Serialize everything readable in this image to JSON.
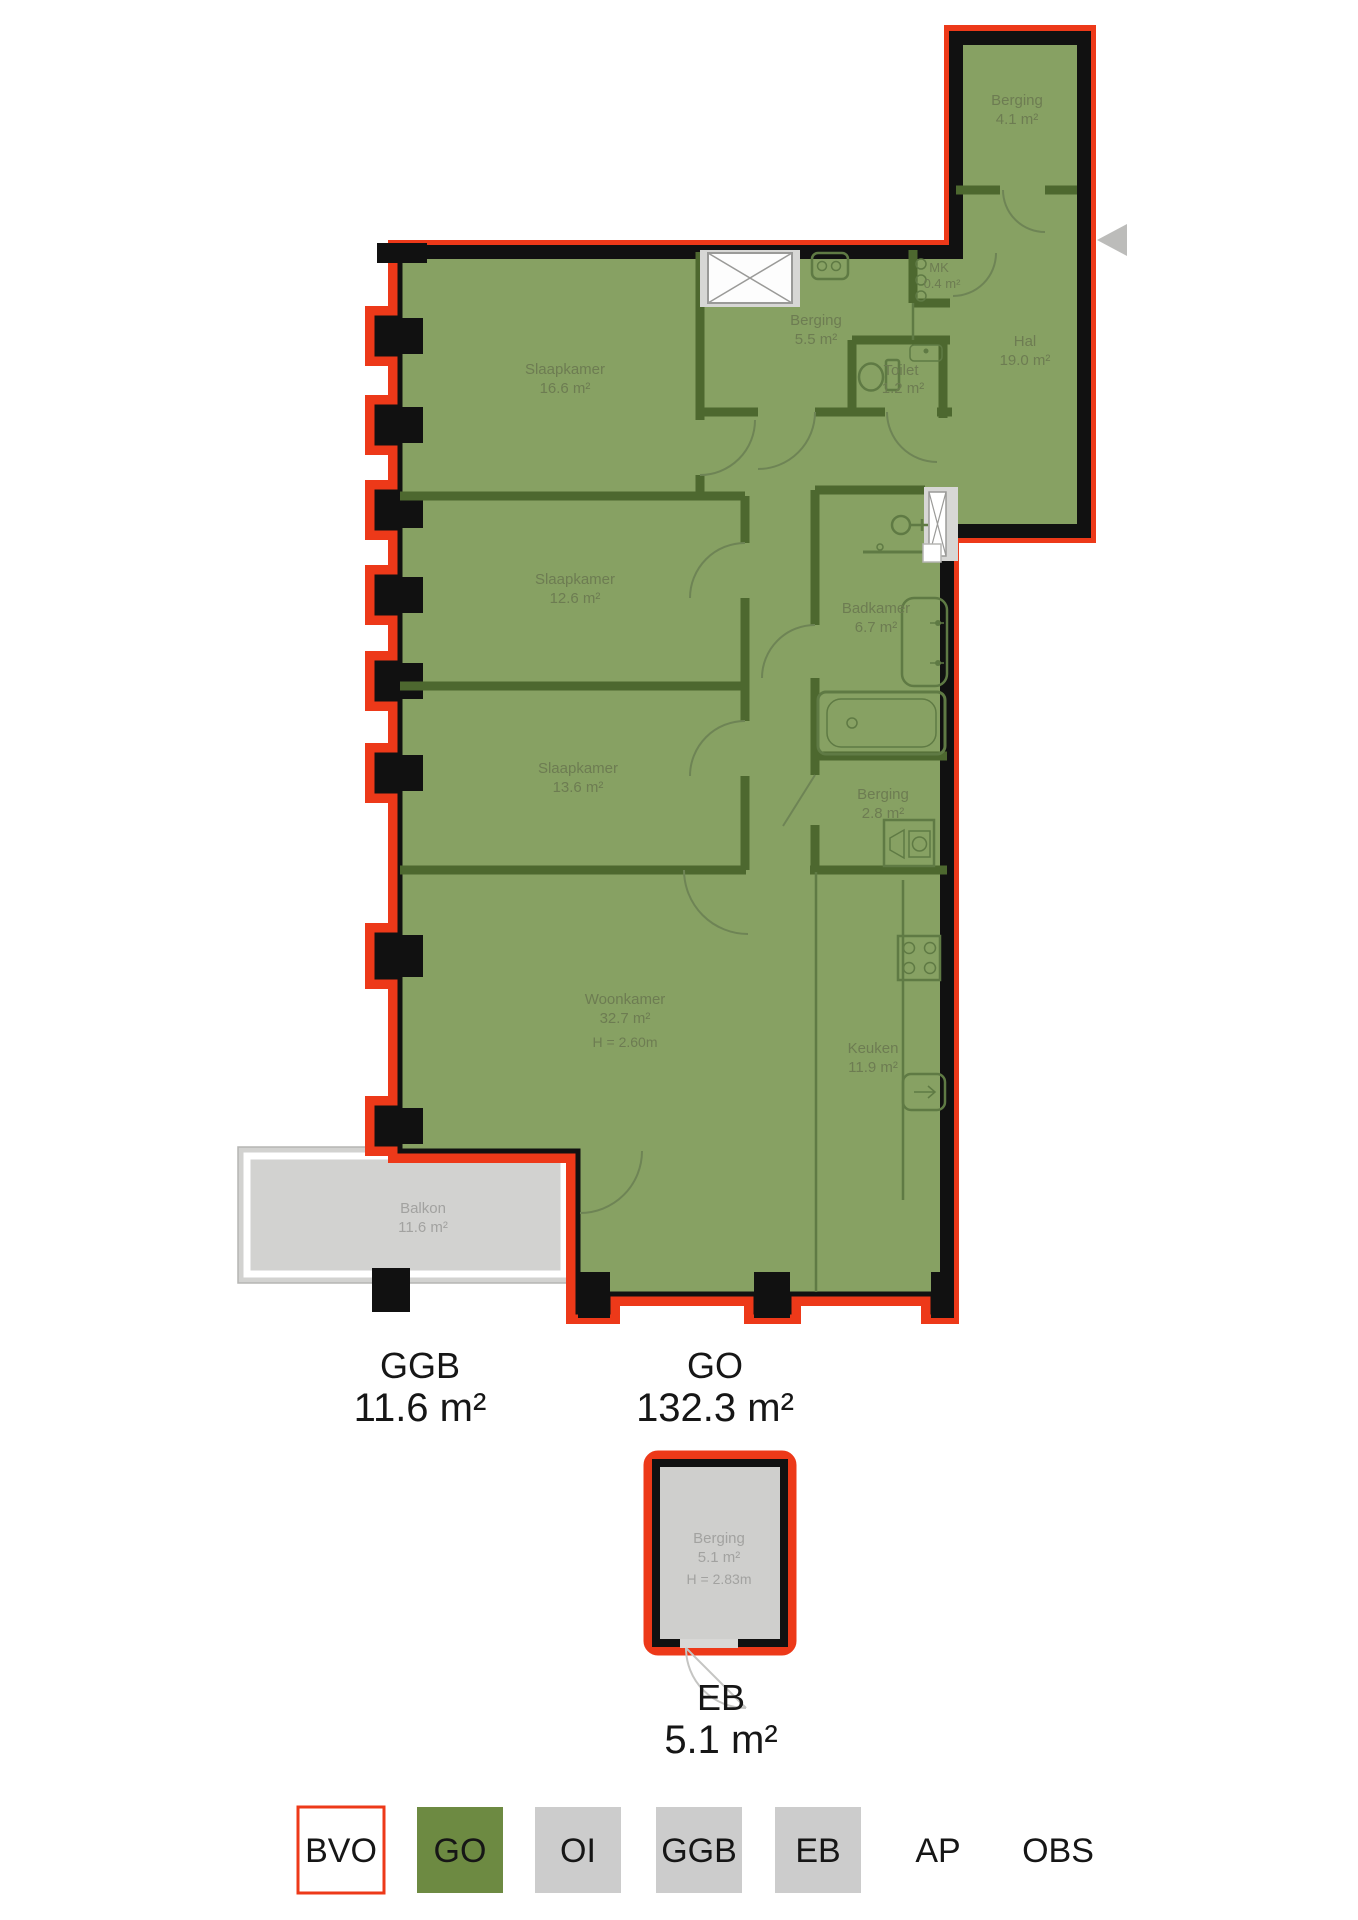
{
  "title": "Apartment floor plan with area measurements",
  "plan": {
    "rooms": [
      {
        "name": "Berging",
        "area": "4.1 m²"
      },
      {
        "name": "Berging",
        "area": "5.5 m²"
      },
      {
        "name": "MK",
        "area": "0.4 m²"
      },
      {
        "name": "Toilet",
        "area": "1.2 m²"
      },
      {
        "name": "Hal",
        "area": "19.0 m²"
      },
      {
        "name": "Slaapkamer",
        "area": "16.6 m²"
      },
      {
        "name": "Slaapkamer",
        "area": "12.6 m²"
      },
      {
        "name": "Slaapkamer",
        "area": "13.6 m²"
      },
      {
        "name": "Badkamer",
        "area": "6.7 m²"
      },
      {
        "name": "Berging",
        "area": "2.8 m²"
      },
      {
        "name": "Woonkamer",
        "area": "32.7 m²",
        "height": "H = 2.60m"
      },
      {
        "name": "Keuken",
        "area": "11.9 m²"
      },
      {
        "name": "Balkon",
        "area": "11.6 m²"
      },
      {
        "name": "Berging",
        "area": "5.1 m²",
        "height": "H = 2.83m"
      }
    ],
    "summary": {
      "ggb": {
        "label": "GGB",
        "value": "11.6 m²"
      },
      "go": {
        "label": "GO",
        "value": "132.3 m²"
      },
      "eb": {
        "label": "EB",
        "value": "5.1 m²"
      }
    }
  },
  "legend": {
    "items": [
      {
        "label": "BVO",
        "swatch": "white-red-outline"
      },
      {
        "label": "GO",
        "swatch": "green"
      },
      {
        "label": "OI",
        "swatch": "gray"
      },
      {
        "label": "GGB",
        "swatch": "gray"
      },
      {
        "label": "EB",
        "swatch": "gray"
      },
      {
        "label": "AP",
        "swatch": "none"
      },
      {
        "label": "OBS",
        "swatch": "none"
      }
    ]
  },
  "icons": {
    "elevator": "elevator-shaft-icon",
    "intercom": "intercom-icon",
    "entry_arrow": "entry-direction-arrow-icon",
    "front_door": "front-door-icon",
    "lock": "door-lock-icon",
    "toilet": "toilet-fixture-icon",
    "washbasin": "washbasin-icon",
    "shower": "shower-icon",
    "bathtub": "bathtub-icon",
    "washer": "washer-dryer-icon",
    "stove": "stove-icon",
    "dishwasher": "dishwasher-icon",
    "meters": "meter-cabinet-icon"
  },
  "colors": {
    "bvo_red": "#ed3919",
    "go_green_fill": "#87a163",
    "go_green_legend": "#6d8a42",
    "interior_wall": "#4d682f",
    "outer_wall": "#111111",
    "legend_gray": "#cccccc",
    "balcony_gray": "#d2d2d0",
    "room_label": "#6d7c52",
    "gray_label": "#a2a2a0"
  }
}
